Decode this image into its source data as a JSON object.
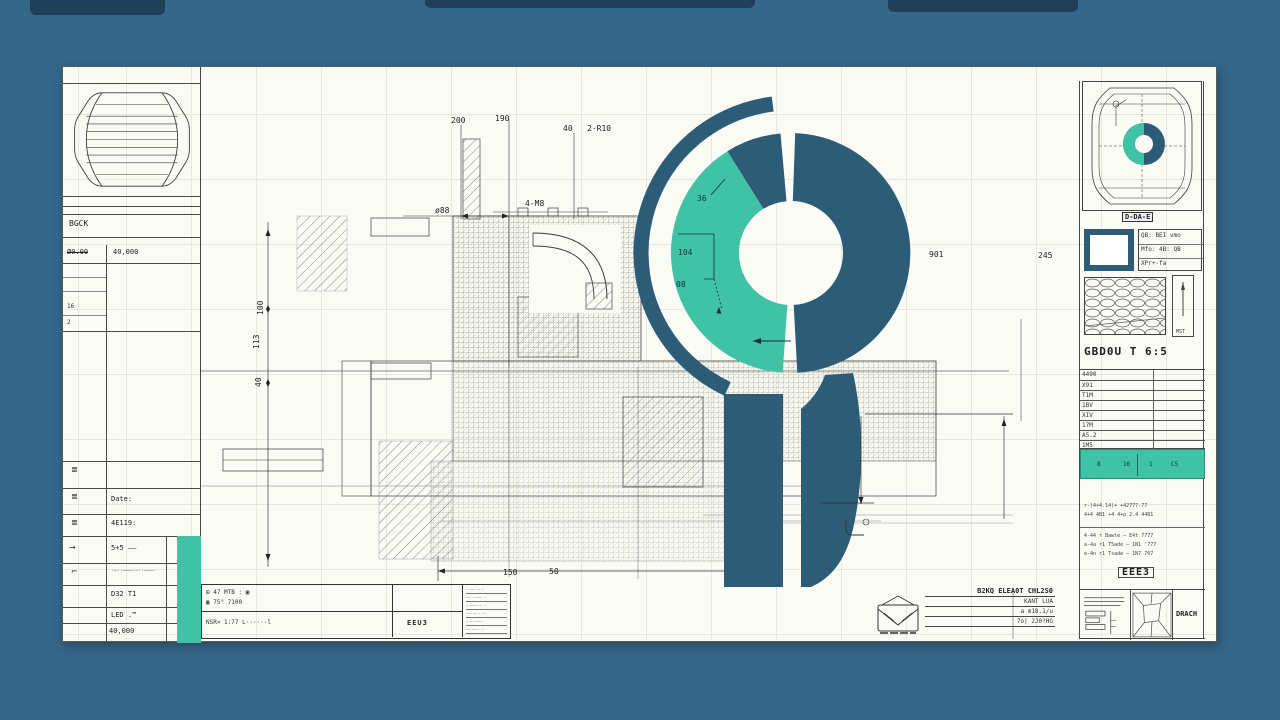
{
  "colors": {
    "background": "#35678a",
    "sheet": "#fbfbf6",
    "brand_dark": "#2d5c77",
    "brand_green": "#3fc3a4",
    "ink": "#2b2b28"
  },
  "logo": {
    "name": "abstract-g-gauge-logomark"
  },
  "dims": {
    "top_200": "200",
    "top_190": "190",
    "top_40": "40",
    "top_r10": "2-R10",
    "mid_o88": "ø88",
    "mid_m8": "4-M8",
    "left_100": "100",
    "left_113": "113",
    "left_40": "40",
    "bottom_150": "150",
    "bottom_50": "50",
    "right_901": "901",
    "right_245": "245",
    "green_36": "36",
    "green_104": "104",
    "green_08": "08"
  },
  "left_panel": {
    "header": "BGCK",
    "spec_label": "Ø0.00",
    "spec_value": "40,000",
    "sub_16": "16",
    "sub_2": "2",
    "sym_hatch1": "≣",
    "sym_hatch2": "≣",
    "sym_hatch3": "≣",
    "sym_arrow": "→",
    "sym_corner": "⌐",
    "row_date": "Date:",
    "row_code": "4E119:",
    "row_sum": "5+5 ——",
    "row_dashes": "·–··–––·–··–––·",
    "row_d32": "D32  T1",
    "row_led": "LED .™",
    "row_total": "40,000"
  },
  "right_panel": {
    "tag": "D-DA-E",
    "info_rows": [
      "QB: BEI vmo",
      "Mfo: 4B: QB",
      "XPr+-fa"
    ],
    "needle_caption": "MST",
    "part_no": "GBD0U T 6:5",
    "table_rows": [
      "4490",
      "X91",
      "T1M",
      "1BV",
      "XIV",
      "17M",
      "A5.2",
      "1M5"
    ],
    "teal_cells": [
      "8",
      "16",
      "1",
      "C5"
    ],
    "micro_note_1": "r-(4+4.14)+ +42777-77",
    "micro_note_2": "4+4 4B1 +4 4+p 2.4 44B1",
    "note_rows": [
      "4-44 r Bawte — E4t 7777",
      "a-4a r1 T5ade — 1N1 '777",
      "e-4n r1 Tsade — 1N7 707"
    ],
    "stamp_label": "EEE3",
    "corner_label": "DRACH"
  },
  "title_block": {
    "r1_line1": "⊞ 47 MTB : ▣",
    "r1_line2": "▣ 75° 7100",
    "r2_line": "NSR× 1:77 L······l",
    "center_label": "EEU3",
    "micro_lines": [
      "– ––– –– –",
      "–– – –––– –",
      "– –––– –– –",
      "––– –– – ––",
      "– –– ––––",
      "–– ––– – –"
    ]
  },
  "stamp_text": {
    "title": "B2KQ ELEA0T CHL2S0",
    "row1": "KANT LUA",
    "row2": "a m18.1/u",
    "row3": "7o| 2J0?HG"
  }
}
